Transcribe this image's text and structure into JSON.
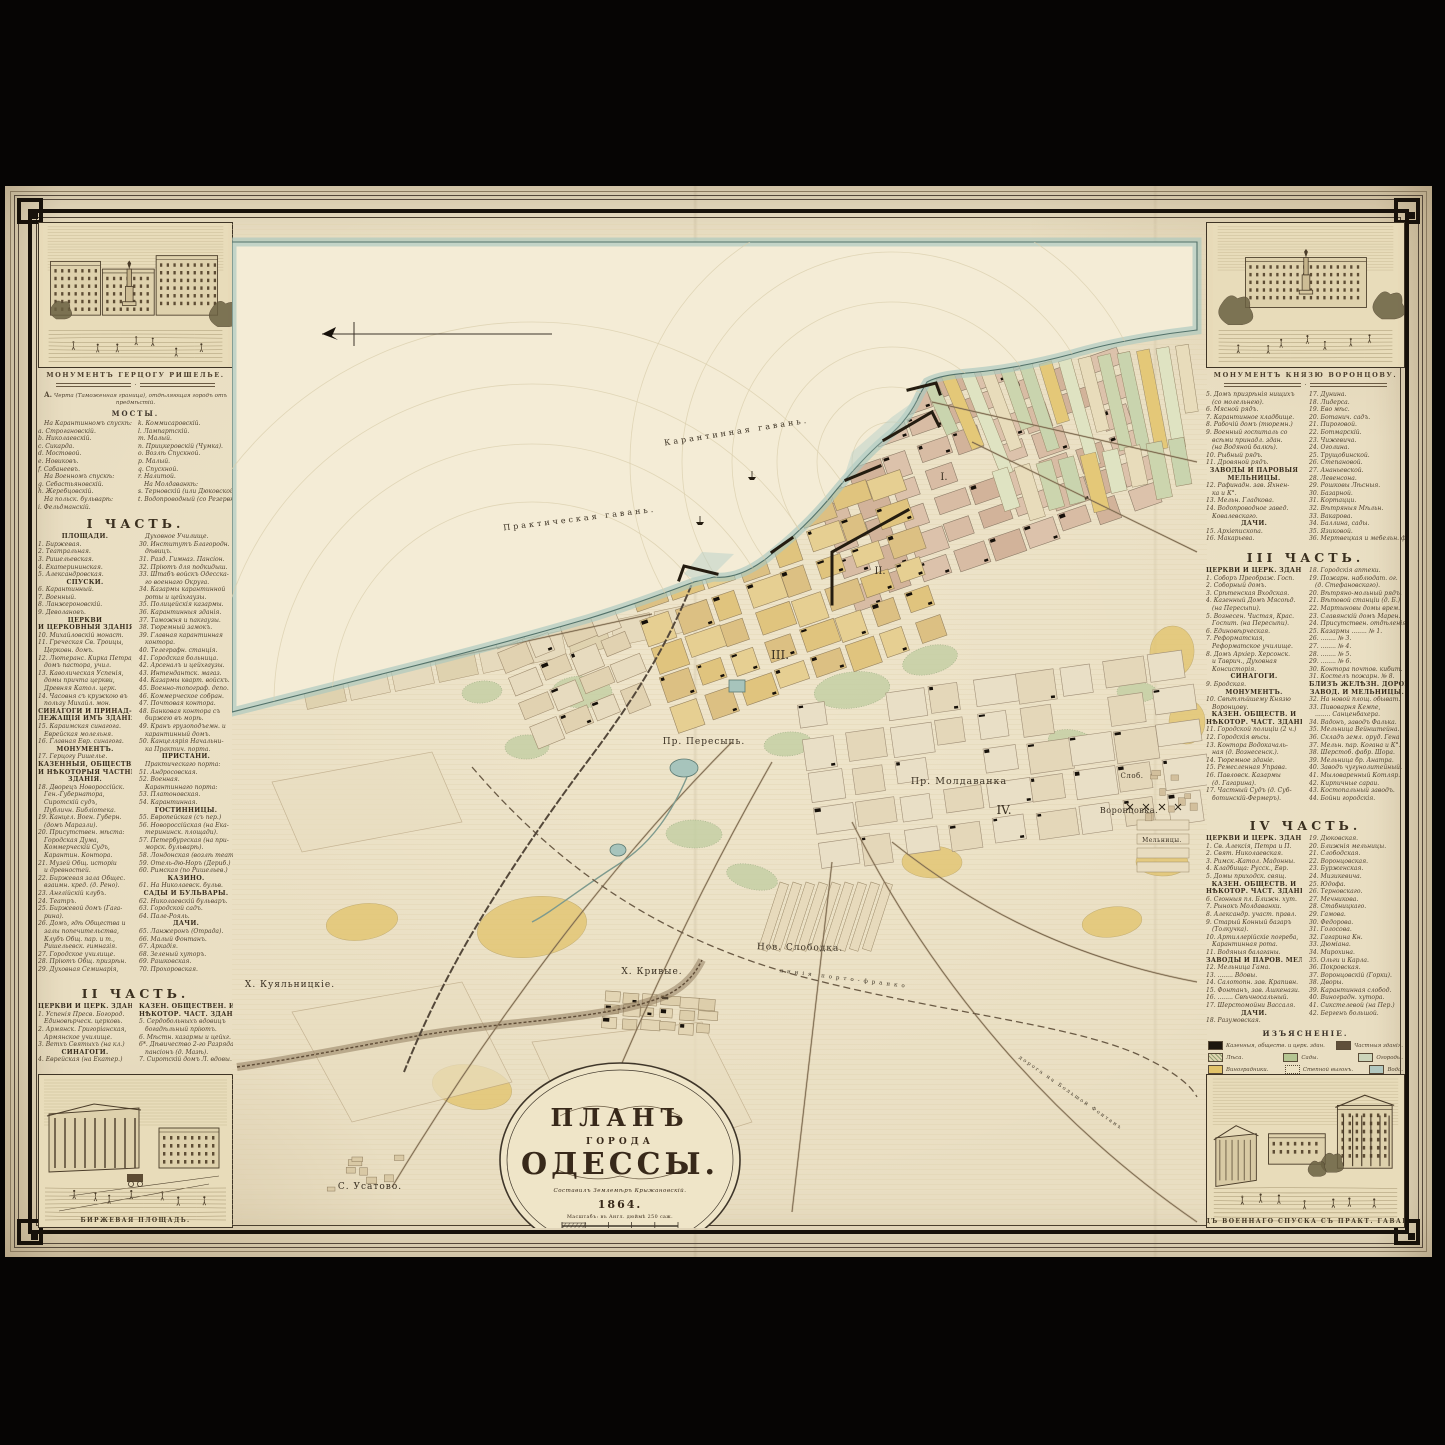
{
  "meta": {
    "sheet_title": "ПЛАНЪ ГОРОДА ОДЕССЫ 1864"
  },
  "palette": {
    "paper": "#e9dec2",
    "ink": "#3c3329",
    "sea": "#f4ecd6",
    "sea_band": "#a9c8bf",
    "water_line": "#53726a",
    "block_pink": "#d8bca4",
    "block_yellow": "#e0c47e",
    "block_tan": "#e9dfc6",
    "garden": "#c3cfa3",
    "field": "#e2c36a",
    "black": "#17110a"
  },
  "left": {
    "v_top_caption": "МОНУМЕНТЪ ГЕРЦОГУ РИШЕЛЬЕ.",
    "v_bottom_caption": "БИРЖЕВАЯ ПЛОЩАДЬ.",
    "note": "Черта (Таможенная граница), отдѣляющая городъ отъ предмѣстій.",
    "note_letter": "А.",
    "bridges_title": "МОСТЫ.",
    "bridges_a": [
      "На Карантинномъ спускѣ:",
      "a. Строгановскій.",
      "b. Николаевскій.",
      "c. Сикарда.",
      "d. Мостовой.",
      "e. Новиковъ.",
      "f. Сабанеевъ.",
      "На Военномъ спускѣ:",
      "g. Себастьяновскій.",
      "h. Жеребцовскій.",
      "На польск. бульварѣ:",
      "i. Фельдманскій."
    ],
    "bridges_b": [
      "k. Коммисаровскій.",
      "l. Лампартскій.",
      "m. Малый.",
      "n. Прицкеровскій (Чумка).",
      "o. Возлѣ Спускной.",
      "p. Малый.",
      "q. Спускной.",
      "r. Налитой.",
      "На Молдаванкѣ:",
      "s. Терновскій (или Дюковской дамбы).",
      "t. Водопроводный (со Резервной дамбы)."
    ],
    "part1_title": "I ЧАСТЬ.",
    "part1": [
      "#ПЛОЩАДИ.",
      "1. Биржевая.",
      "2. Театральная.",
      "3. Ришельевская.",
      "4. Екатерининская.",
      "5. Александровская.",
      "#СПУСКИ.",
      "6. Карантинный.",
      "7. Военный.",
      "8. Ланжероновскій.",
      "9. Деволановъ.",
      "#ЦЕРКВИ",
      "#И ЦЕРКОВНЫЯ ЗДАНІЯ.",
      "10. Михайловскій монаст.",
      "11. Греческая Св. Троицы,",
      "Церковн. домъ.",
      "12. Лютеранс. Кирка Петра,",
      "домъ пастора, учил.",
      "13. Каѳолическая Успенія,",
      "домы причта церкви,",
      "Древняя Катол. церк.",
      "14. Часовня съ кружкою въ",
      "пользу Михайл. мон.",
      "#СИНАГОГИ И ПРИНАД-",
      "#ЛЕЖАЩІЯ ИМЪ ЗДАНІЯ.",
      "15. Караимская синагога.",
      "Еврейская молельня.",
      "16. Главная Евр. синагога.",
      "#МОНУМЕНТЪ.",
      "17. Герцогу Ришелье.",
      "#КАЗЕННЫЯ, ОБЩЕСТВЕН.",
      "#И НѢКОТОРЫЯ ЧАСТНЫЯ",
      "#ЗДАНІЯ.",
      "18. Дворецъ Новороссійск.",
      "Ген.-Губернатора,",
      "Сиротскій судъ,",
      "Публичн. Библіотека.",
      "19. Канцел. Воен. Губерн.",
      "(домъ Маразли).",
      "20. Присутствен. мѣста:",
      "Городская Дума,",
      "Коммерческій Судъ,",
      "Карантин. Контора.",
      "21. Музей Общ. исторіи",
      "и древностей.",
      "22. Биржевая зала Общес.",
      "взаимн. кред. (д. Рено).",
      "23. Англійскій клубъ.",
      "24. Театръ.",
      "25. Биржевой домъ (Гага-",
      "рина).",
      "26. Домъ, гдѣ Общества и",
      "залы попечительства,",
      "Клубъ Общ. пар. и т.,",
      "Ришельевск. гимназія.",
      "27. Городское училище.",
      "28. Пріютъ Общ. призрѣн.",
      "29. Духовная Семинарія,",
      "Духовное Училище.",
      "30. Институтъ Благородн.",
      "дѣвицъ.",
      "31. Разд. Гимназ. Пансіон.",
      "32. Пріютъ для подкидыш.",
      "33. Штабъ войскъ Одесска-",
      "го военнаго Округа.",
      "34. Казармы карантинной",
      "роты и цейхгаузы.",
      "35. Полицейскія казармы.",
      "36. Карантинныя зданія.",
      "37. Таможня и пакгаузы.",
      "38. Тюремный замокъ.",
      "39. Главная карантинная",
      "контора.",
      "40. Телеграфн. станція.",
      "41. Городская больница.",
      "42. Арсеналъ и цейхгаузы.",
      "43. Интендантск. магаз.",
      "44. Казармы кварт. войскъ.",
      "45. Военно-топограф. депо.",
      "46. Коммерческое собран.",
      "47. Почтовая контора.",
      "48. Банковая контора съ",
      "биржею въ морѣ.",
      "49. Кранъ грузоподъемн. и",
      "карантинный домъ.",
      "50. Канцелярія Начальни-",
      "ка Практич. порта.",
      "#ПРИСТАНИ.",
      "Практическаго порта:",
      "51. Андросовская.",
      "52. Военная.",
      "Карантиннаго порта:",
      "53. Платоновская.",
      "54. Карантинная.",
      "#ГОСТИННИЦЫ.",
      "55. Европейская (съ пер.)",
      "56. Новороссійская (на Ека-",
      "терининск. площади).",
      "57. Петербургская (на при-",
      "морск. бульварѣ).",
      "58. Лондонская (возлѣ теат.)",
      "59. Отель-дю-Норъ (Дериб.)",
      "60. Римская (по Ришельев.)",
      "#КАЗИНО.",
      "61. На Николаевск. бульв.",
      "#САДЫ И БУЛЬВАРЫ.",
      "62. Николаевскій бульваръ.",
      "63. Городской садъ.",
      "64. Пале-Рояль.",
      "#ДАЧИ.",
      "65. Ланжеронъ (Отрада).",
      "66. Малый Фонтанъ.",
      "67. Аркадія.",
      "68. Зеленый хуторъ.",
      "69. Рашковская.",
      "70. Прохоровская.",
      "71. Виноградная.",
      "72. Ковалевскаго."
    ],
    "part2_title": "II ЧАСТЬ.",
    "part2": [
      "#ЦЕРКВИ И ЦЕРК. ЗДАНІЯ.",
      "1. Успенія Пресв. Богород.",
      "Единовѣрческ. церковь.",
      "2. Армянск. Григоріанская,",
      "Армянское училище.",
      "3. Ветхъ Святыхъ (на кл.)",
      "#СИНАГОГИ.",
      "4. Еврейская (на Екатер.)",
      "#КАЗЕН. ОБЩЕСТВЕН. И",
      "#НѢКОТОР. ЧАСТ. ЗДАНІЕ.",
      "5. Сердобольныхъ вдовицъ",
      "богадѣльный пріютъ.",
      "6. Мѣстн. казармы и цейхг.",
      "6*. Дѣвичество 2-го Разряда",
      "пансіонъ (д. Мазѣ).",
      "7. Сиротскій домъ Л. вдовы."
    ]
  },
  "right": {
    "v_top_caption": "МОНУМЕНТЪ КНЯЗЮ ВОРОНЦОВУ.",
    "v_bottom_caption": "ВИДЪ ВОЕННАГО СПУСКА СЪ ПРАКТ. ГАВАНИ.",
    "cont_list": [
      "5. Домъ призрѣнія нищихъ",
      "(со молельнею).",
      "6. Мясной рядъ.",
      "7. Карантинное кладбище.",
      "8. Рабочій домъ (тюремн.)",
      "9. Военный госпиталь со",
      "всѣми принадл. здан.",
      "(на Водяной балкѣ).",
      "10. Рыбный рядъ.",
      "11. Дровяной рядъ.",
      "#ЗАВОДЫ И ПАРОВЫЯ",
      "#МЕЛЬНИЦЫ.",
      "12. Рафинадн. зав. Яхнен-",
      "ка и К°.",
      "13. Мельн. Гладкова.",
      "14. Водопроводное завед.",
      "Ковалевскаго.",
      "#ДАЧИ.",
      "15. Архіепископа.",
      "16. Макарьева.",
      "17. Дунина.",
      "18. Лидерса.",
      "19. Ево мѣс.",
      "20. Ботанич. садъ.",
      "21. Пироговой.",
      "22. Ботмарскій.",
      "23. Чижевича.",
      "24. Оголина.",
      "25. Трущобинской.",
      "26. Степановой.",
      "27. Ананьевской.",
      "28. Левенсона.",
      "29. Рошковы Лѣсныя.",
      "30. Базарной.",
      "31. Кортацци.",
      "32. Вѣтряныя Мѣльн.",
      "33. Вакарова.",
      "34. Баллина, сады.",
      "35. Язиковой.",
      "36. Мертвецкая и мебельн. ф."
    ],
    "part3_title": "III ЧАСТЬ.",
    "part3": [
      "#ЦЕРКВИ И ЦЕРК. ЗДАН.",
      "1. Соборъ Преображ. Госп.",
      "2. Соборный домъ.",
      "3. Срѣтенская Входская.",
      "4. Казенный Домъ Мясоѣд.",
      "(на Пересыпи).",
      "5. Вознесен. Чистая, Крас.",
      "Госпит. (на Пересыпи).",
      "6. Единовѣрческая.",
      "7. Реформатская,",
      "Реформатское училище.",
      "8. Домъ Архіер. Херсонск.",
      "и Таврич., Духовная",
      "Консисторія.",
      "#СИНАГОГИ.",
      "9. Бродская.",
      "#МОНУМЕНТЪ.",
      "10. Свѣтлѣйшему Князю",
      "Воронцову.",
      "#КАЗЕН. ОБЩЕСТВ. И",
      "#НѢКОТОР. ЧАСТ. ЗДАНІЯ.",
      "11. Городской полиціи (2 ч.)",
      "12. Городскія вѣсы.",
      "13. Контора Водокачаль-",
      "ная (д. Вознесенск.).",
      "14. Тюремное зданіе.",
      "15. Ремесленная Управа.",
      "16. Павловск. Казармы",
      "(д. Гагарина).",
      "17. Частный Судъ (д. Суб-",
      "ботинскій-Фермеръ).",
      "18. Городскія аптеки.",
      "19. Пожарн. наблюдат. ог.",
      "(д. Стефановскаго).",
      "20. Вѣтряно-мольный рядъ.",
      "21. Вѣтовой станціи (д. Б.)",
      "22. Мартыновы домы врем.",
      "23. Славянскій домъ Марен.",
      "24. Присутствен. отдѣленія.",
      "25. Казармы ........ № 1.",
      "26. ........ № 3.",
      "27. ........ № 4.",
      "28. ........ № 5.",
      "29. ........ № 6.",
      "30. Контора почтов. кибит.",
      "31. Костелъ пожарн. № 8.",
      "#БЛИЗЪ ЖЕЛѢЗН. ДОРОГИ",
      "#ЗАВОД. И МЕЛЬНИЦЫ.",
      "32. На новой площ. обыват.",
      "33. Пивоварня Кемпе,",
      "........ Санценбахера.",
      "34. Вадонъ, заводъ Фалька.",
      "35. Мельница Вейнштейна.",
      "36. Складъ земл. оруд. Гена.",
      "37. Мельн. пар. Когана и К°.",
      "38. Шерстоб. фабр. Шора.",
      "39. Мельница бр. Анатра.",
      "40. Заводъ чугунолитейный.",
      "41. Мыловаренный Котляр.",
      "42. Кирпичные сараи.",
      "43. Костопальный заводъ.",
      "44. Бойни городскія."
    ],
    "part4_title": "IV ЧАСТЬ.",
    "part4": [
      "#ЦЕРКВИ И ЦЕРК. ЗДАН.",
      "1. Св. Алексія, Петра и П.",
      "2. Свят. Николаевская.",
      "3. Римск.-Катол. Мадонны.",
      "4. Кладбища: Русск., Евр.",
      "5. Домы приходск. свящ.",
      "#КАЗЕН. ОБЩЕСТВ. И",
      "#НѢКОТОР. ЧАСТ. ЗДАНІЯ.",
      "6. Сгонныя пл. Ближн. хут.",
      "7. Рынокъ Молдаванки.",
      "8. Александр. участ. правл.",
      "9. Старый Конный базаръ",
      "(Толкучка).",
      "10. Артиллерійскіе погреба,",
      "Карантинная рота.",
      "11. Водяныя балаганы.",
      "#ЗАВОДЫ И ПАРОВ. МЕЛЬН.",
      "12. Мельница Гама.",
      "13. ........ Вдовы.",
      "14. Салотопн. зав. Крапивн.",
      "15. Фонтанъ, зав. Ашкенази.",
      "16. ........ Свѣчносальный.",
      "17. Шерстомойни Вассаля.",
      "#ДАЧИ.",
      "18. Разумовская.",
      "19. Дюковская.",
      "20. Ближнія мельницы.",
      "21. Слободская.",
      "22. Воронцовская.",
      "23. Бурженская.",
      "24. Мизикевича.",
      "25. Юдофа.",
      "26. Терновскаго.",
      "27. Мечникова.",
      "28. Стабницкаго.",
      "29. Гамова.",
      "30. Федорова.",
      "31. Голосова.",
      "32. Гагарина Кн.",
      "33. Дюміана.",
      "34. Мирохина.",
      "35. Ольги и Карла.",
      "36. Покровская.",
      "37. Воронцовскій (Горки).",
      "38. Дворы.",
      "39. Карантинная слобод.",
      "40. Виноградн. хутора.",
      "41. Сикстелевой (на Пер.)",
      "42. Бергенъ большой."
    ],
    "legend_title": "ИЗЪЯСНЕНІЕ.",
    "legend": [
      {
        "k": "bldg-public",
        "label": "Казенныя, обществ. и церк. здан."
      },
      {
        "k": "bldg-private",
        "label": "Частныя зданія."
      },
      {
        "k": "forest",
        "label": "Лѣса."
      },
      {
        "k": "garden",
        "label": "Сады."
      },
      {
        "k": "kitchen",
        "label": "Огороды."
      },
      {
        "k": "vineyard",
        "label": "Виноградники."
      },
      {
        "k": "steppe",
        "label": "Степной выгонъ."
      },
      {
        "k": "water",
        "label": "Вода."
      }
    ],
    "signature": "Грав. К. Кальмансономъ."
  },
  "map": {
    "labels": [
      {
        "t": "Карантинная гавань.",
        "x": 505,
        "y": 212,
        "r": -9,
        "s": 8,
        "ls": 3
      },
      {
        "t": "Практическая гавань.",
        "x": 348,
        "y": 299,
        "r": -7,
        "s": 8,
        "ls": 3
      },
      {
        "t": "Пр. Пересыпь.",
        "x": 472,
        "y": 522,
        "r": 0,
        "s": 9,
        "ls": 1
      },
      {
        "t": "Пр. Молдаванка",
        "x": 727,
        "y": 562,
        "r": 0,
        "s": 9.5,
        "ls": 1
      },
      {
        "t": "I.",
        "x": 712,
        "y": 258,
        "r": 0,
        "s": 10,
        "ls": 0
      },
      {
        "t": "II.",
        "x": 648,
        "y": 352,
        "r": 0,
        "s": 10,
        "ls": 0
      },
      {
        "t": "III.",
        "x": 548,
        "y": 437,
        "r": 0,
        "s": 12,
        "ls": 0
      },
      {
        "t": "IV.",
        "x": 772,
        "y": 592,
        "r": 0,
        "s": 12,
        "ls": 0
      },
      {
        "t": "Слоб.",
        "x": 900,
        "y": 556,
        "r": 0,
        "s": 7,
        "ls": 0.5
      },
      {
        "t": "Воронцовка.",
        "x": 897,
        "y": 591,
        "r": 0,
        "s": 8,
        "ls": 0.5
      },
      {
        "t": "Мельницы.",
        "x": 930,
        "y": 620,
        "r": 0,
        "s": 6,
        "ls": 0.5
      },
      {
        "t": "Нов. Слободка.",
        "x": 568,
        "y": 728,
        "r": 1,
        "s": 9,
        "ls": 1
      },
      {
        "t": "Х. Кривые.",
        "x": 420,
        "y": 752,
        "r": 0,
        "s": 9,
        "ls": 1
      },
      {
        "t": "Х. Куяльницкіе.",
        "x": 58,
        "y": 765,
        "r": 0,
        "s": 9,
        "ls": 1
      },
      {
        "t": "С. Усатово.",
        "x": 138,
        "y": 967,
        "r": 0,
        "s": 9,
        "ls": 1
      },
      {
        "t": "линія  порто-франко",
        "x": 612,
        "y": 758,
        "r": 7,
        "s": 5.5,
        "ls": 4
      },
      {
        "t": "дорога на Большой Фонтанъ",
        "x": 838,
        "y": 872,
        "r": 35,
        "s": 5,
        "ls": 2
      }
    ],
    "cartouche": {
      "l1": "ПЛАНЪ",
      "l2": "ГОРОДА",
      "l3": "ОДЕССЫ.",
      "byline": "Составилъ Землемѣръ Крыжановскій.",
      "year": "1864.",
      "scale_note": "Масштабъ: въ Англ. дюймѣ 250 саж.",
      "scale_ticks": "250   0   250   500   750   1000"
    }
  }
}
